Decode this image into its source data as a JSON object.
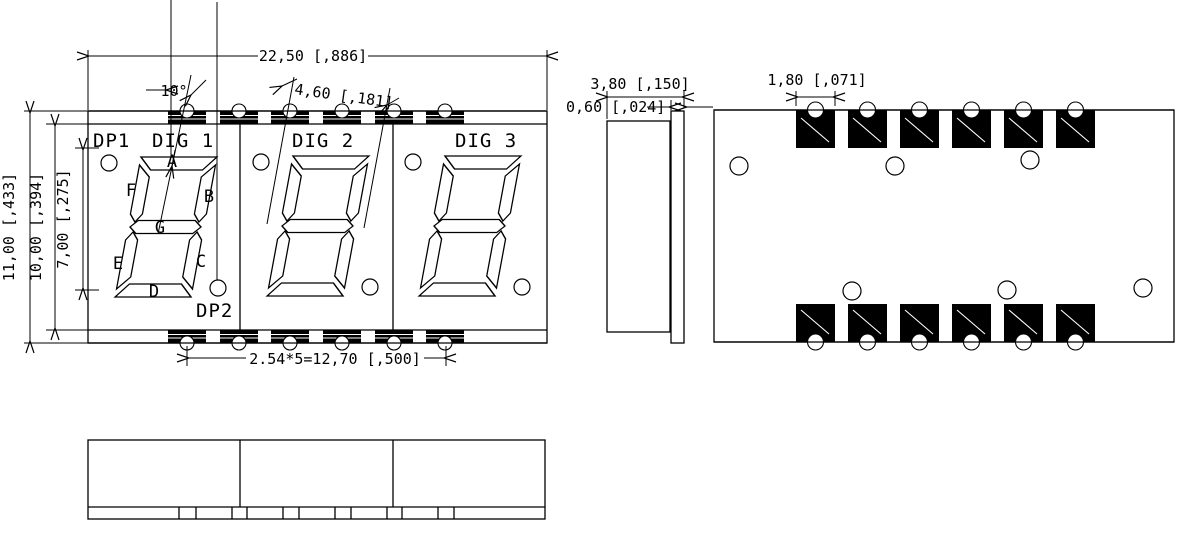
{
  "front_view": {
    "dp1": "DP1",
    "dig1": "DIG 1",
    "dig2": "DIG 2",
    "dig3": "DIG 3",
    "dp2": "DP2",
    "seg_a": "A",
    "seg_b": "B",
    "seg_c": "C",
    "seg_d": "D",
    "seg_e": "E",
    "seg_f": "F",
    "seg_g": "G"
  },
  "dimensions": {
    "overall_width": "22,50 [,886]",
    "slant_angle": "10°",
    "digit_width": "4,60 [,181]",
    "overall_height": "11,00 [,433]",
    "body_height": "10,00 [,394]",
    "digit_height": "7,00 [,275]",
    "pad_pitch": "2.54*5=12,70 [,500]",
    "total_thickness": "3,80 [,150]",
    "pcb_thickness": "0,60 [,024]",
    "pad_width": "1,80 [,071]"
  },
  "colors": {
    "line": "#000000",
    "background": "#ffffff",
    "pad_fill": "#000000"
  }
}
